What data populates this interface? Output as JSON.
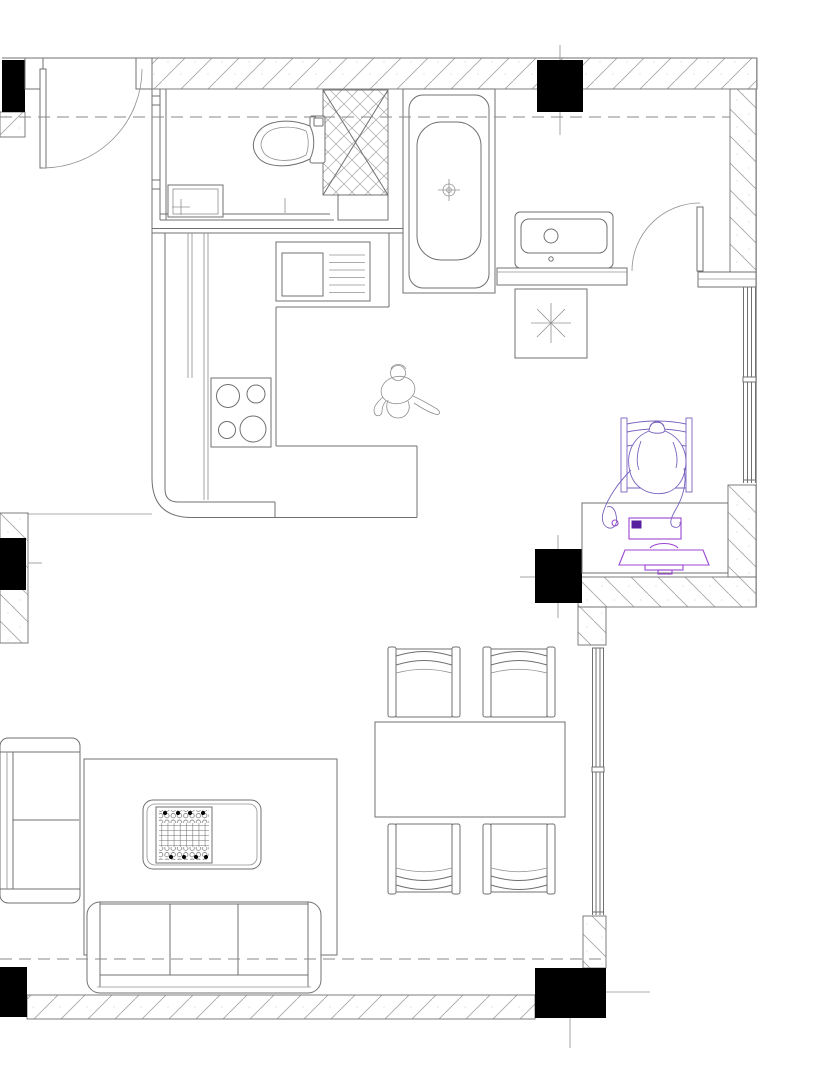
{
  "canvas": {
    "width": 828,
    "height": 1087,
    "background": "#ffffff"
  },
  "colors": {
    "line": "#707070",
    "thin": "#909090",
    "black": "#000000",
    "hatch": "#a8a8a8",
    "stipple": "#c2c2c2",
    "figure": "#7a63be",
    "device": "#9b45d2",
    "device_dark": "#571f9e",
    "dashc": "#8a8a8a"
  },
  "plan": {
    "type": "residential-floor-plan",
    "structure": {
      "black_columns": 5,
      "swing_doors": 2,
      "windows": 2,
      "shaft_with_cross_bracing": 1,
      "datum_dashed_lines": 2
    },
    "rooms": [
      {
        "name": "bathroom",
        "items": [
          "toilet",
          "wash-basin"
        ]
      },
      {
        "name": "kitchen",
        "items": [
          "l-shaped-counter",
          "sink-with-drainboard",
          "four-burner-cooktop",
          "standing-person"
        ]
      },
      {
        "name": "hall",
        "items": [
          "entry-door",
          "bathtub",
          "vanity-basin",
          "square-with-asterisk-symbol",
          "interior-door"
        ]
      },
      {
        "name": "workspace",
        "items": [
          "desk",
          "task-chair",
          "seated-person-at-computer",
          "keyboard",
          "monitor",
          "mouse"
        ]
      },
      {
        "name": "dining-area",
        "items": [
          "dining-table",
          "dining-chair",
          "dining-chair",
          "dining-chair",
          "dining-chair"
        ]
      },
      {
        "name": "living-room",
        "items": [
          "two-seat-sofa",
          "three-seat-sofa",
          "patterned-rug",
          "coffee-table",
          "game-board"
        ]
      }
    ]
  }
}
